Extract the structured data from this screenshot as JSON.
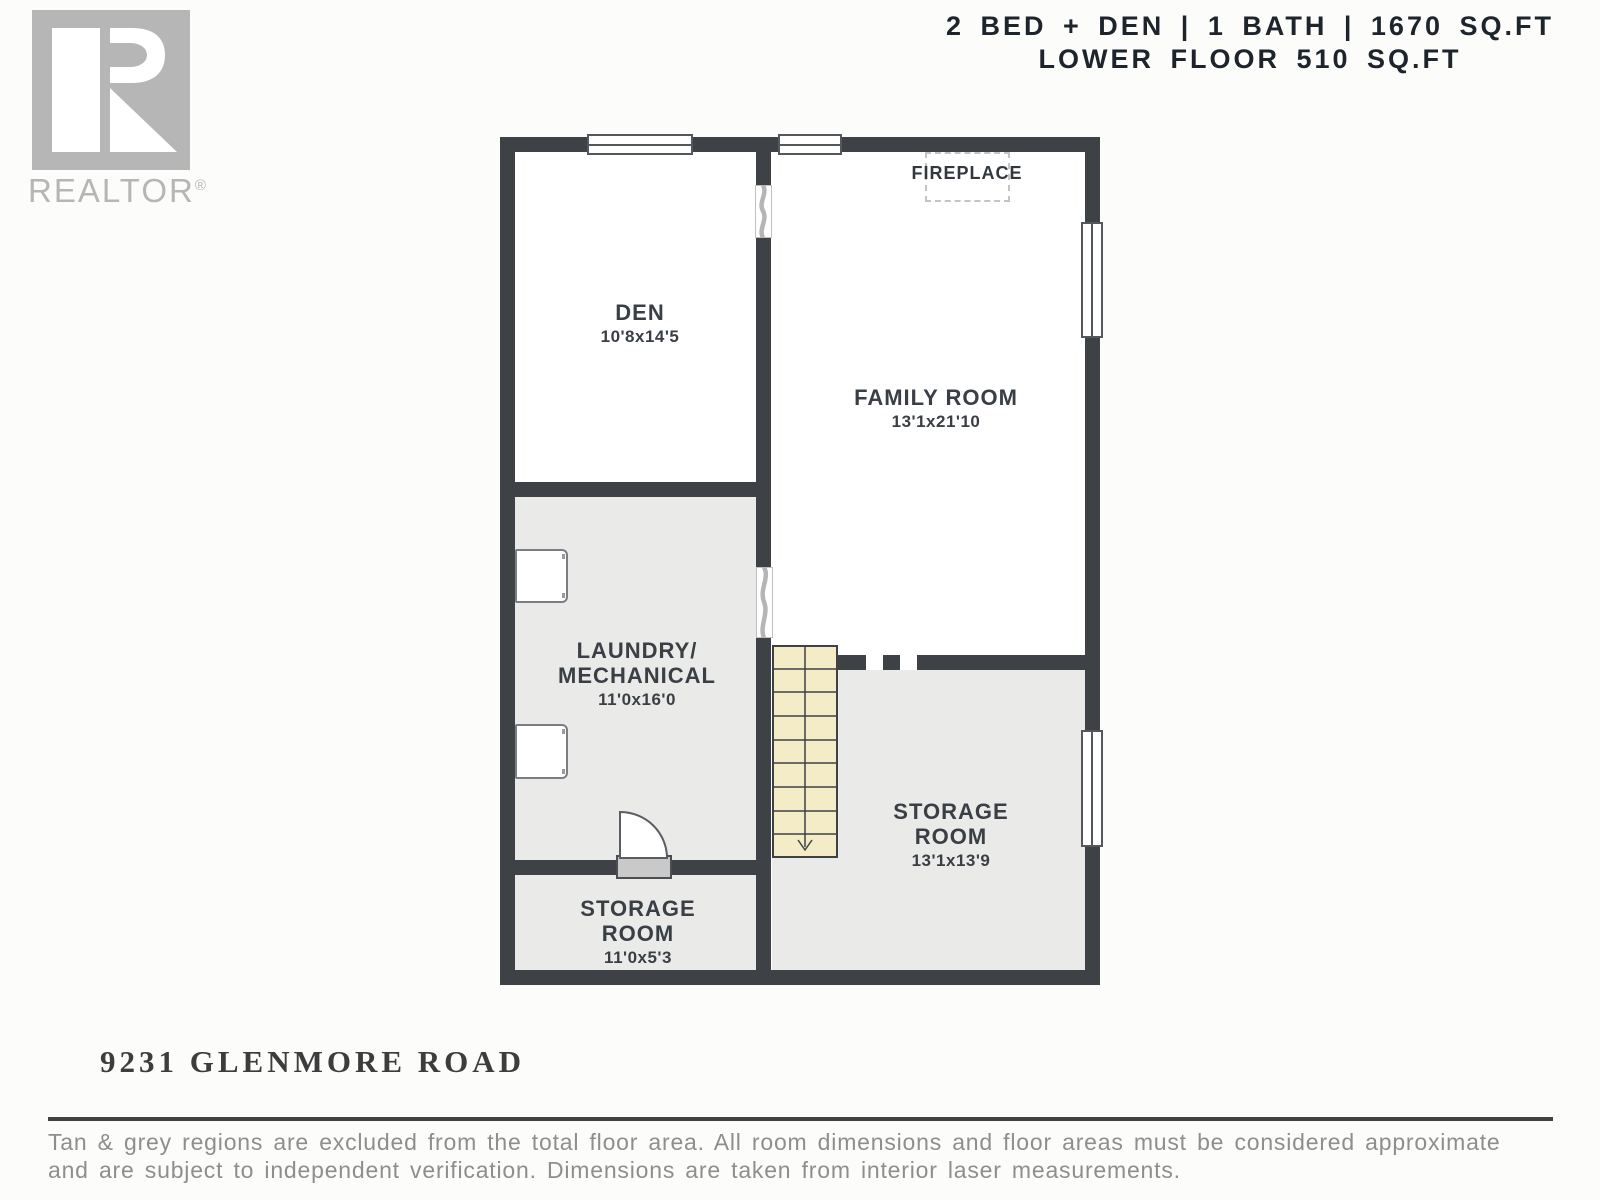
{
  "branding": {
    "logo_text": "REALTOR",
    "logo_reg": "®"
  },
  "header": {
    "line1": "2 BED + DEN | 1 BATH | 1670 SQ.FT",
    "line2": "LOWER FLOOR 510 SQ.FT"
  },
  "rooms": {
    "den": {
      "name": "DEN",
      "dims": "10'8x14'5"
    },
    "family": {
      "name": "FAMILY ROOM",
      "dims": "13'1x21'10"
    },
    "laundry": {
      "name1": "LAUNDRY/",
      "name2": "MECHANICAL",
      "dims": "11'0x16'0"
    },
    "storage_main": {
      "name1": "STORAGE",
      "name2": "ROOM",
      "dims": "13'1x13'9"
    },
    "storage_small": {
      "name1": "STORAGE",
      "name2": "ROOM",
      "dims": "11'0x5'3"
    }
  },
  "features": {
    "fireplace_label": "FIREPLACE"
  },
  "footer": {
    "address": "9231 GLENMORE ROAD",
    "disclaimer_line1": "Tan & grey regions are excluded from the total floor area. All room dimensions and floor areas must be considered approximate",
    "disclaimer_line2": "and are subject to independent verification. Dimensions are taken from interior laser measurements."
  },
  "colors": {
    "wall": "#3e4247",
    "excluded_floor": "#eaeae8",
    "stairs_tan": "#f4ecc6",
    "logo_gray": "#b6b6b6",
    "title_text": "#1e242c",
    "label_text": "#3a3f45",
    "disclaimer_text": "#8d8e8e"
  }
}
